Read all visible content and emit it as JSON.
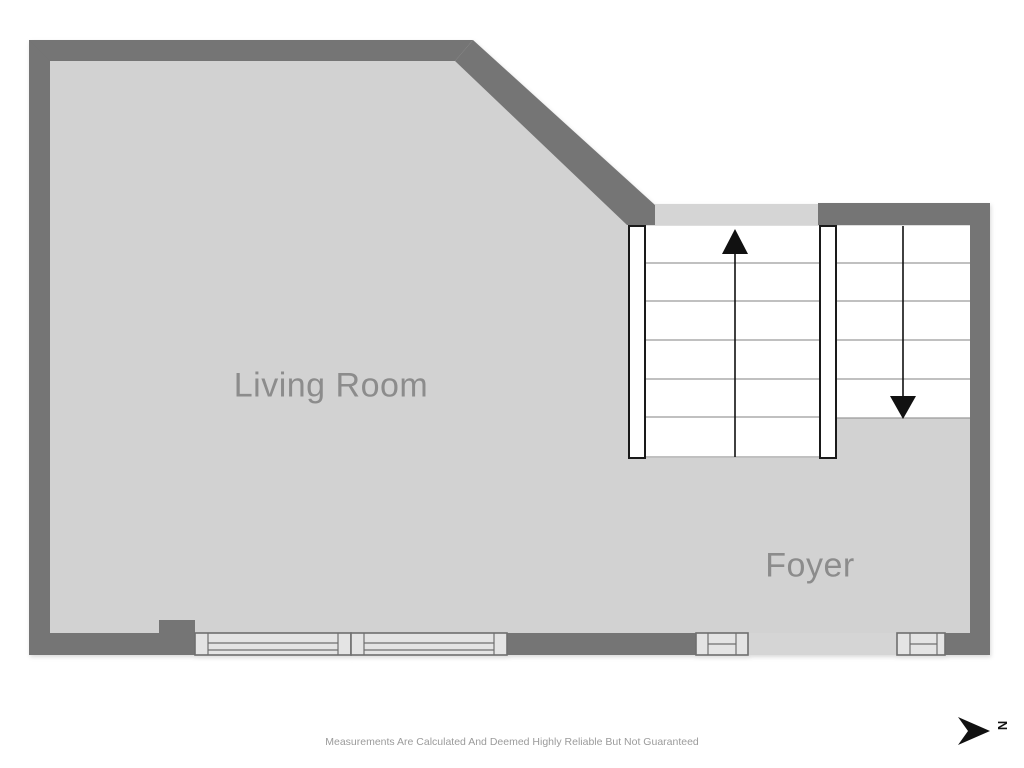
{
  "page": {
    "background": "#ffffff"
  },
  "colors": {
    "pagebg": "#ffffff",
    "wall": "#757575",
    "floor": "#d2d2d2",
    "band": "#d5d5d5",
    "stairline": "#9a9a9a",
    "stringer": "#1a1a1a",
    "arrow": "#111111",
    "winfill": "#e4e4e4",
    "winborder": "#6f6f6f",
    "roomlabel": "#8c8c8c",
    "disclaimertxt": "#9b9b9b"
  },
  "rooms": {
    "living_room": {
      "label": "Living Room"
    },
    "foyer": {
      "label": "Foyer"
    }
  },
  "stairs": {
    "up_run_steps": 6,
    "down_run_steps": 5,
    "up_arrow": "up",
    "down_arrow": "down"
  },
  "windows": {
    "count": 4
  },
  "compass": {
    "label": "N",
    "direction": "right"
  },
  "footer": {
    "disclaimer": "Measurements Are Calculated And Deemed Highly Reliable But Not Guaranteed"
  }
}
